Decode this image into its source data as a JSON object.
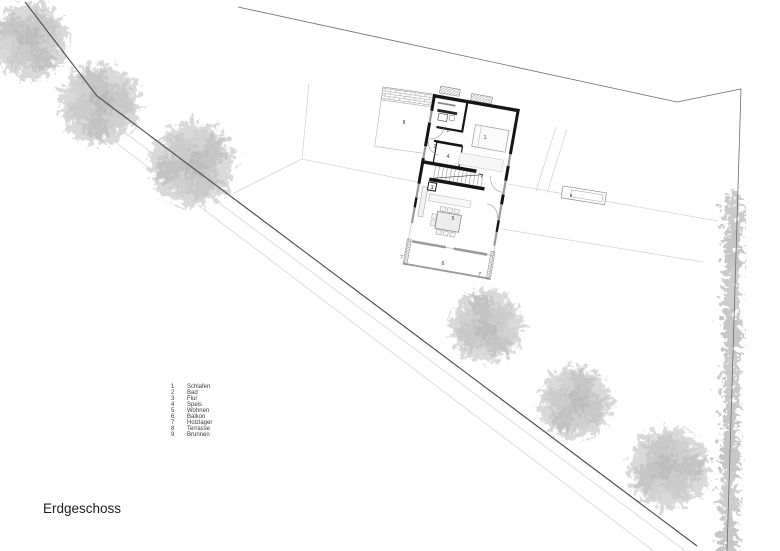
{
  "page": {
    "title": "Erdgeschoss"
  },
  "legend": {
    "items": [
      {
        "num": "1",
        "label": "Schlafen"
      },
      {
        "num": "2",
        "label": "Bad"
      },
      {
        "num": "3",
        "label": "Flur"
      },
      {
        "num": "4",
        "label": "Speis"
      },
      {
        "num": "5",
        "label": "Wohnen"
      },
      {
        "num": "6",
        "label": "Balkon"
      },
      {
        "num": "7",
        "label": "Holzlager"
      },
      {
        "num": "8",
        "label": "Terrasse"
      },
      {
        "num": "9",
        "label": "Brunnen"
      }
    ]
  },
  "plan": {
    "labels": {
      "schlafen": "1",
      "bad": "2",
      "bad2": "2",
      "flur": "3",
      "speis": "4",
      "wohnen": "5",
      "balkon": "6",
      "holzlager_left": "7",
      "holzlager_right": "7",
      "terrasse": "8",
      "brunnen": "9"
    }
  },
  "colors": {
    "wall": "#151515",
    "window_gray": "#9a9a9a",
    "boundary_dark": "#4d4d4d",
    "boundary_light": "#6e6e6e",
    "site_line": "#d2d2d2",
    "tree": "#cccccc",
    "text": "#333333"
  }
}
